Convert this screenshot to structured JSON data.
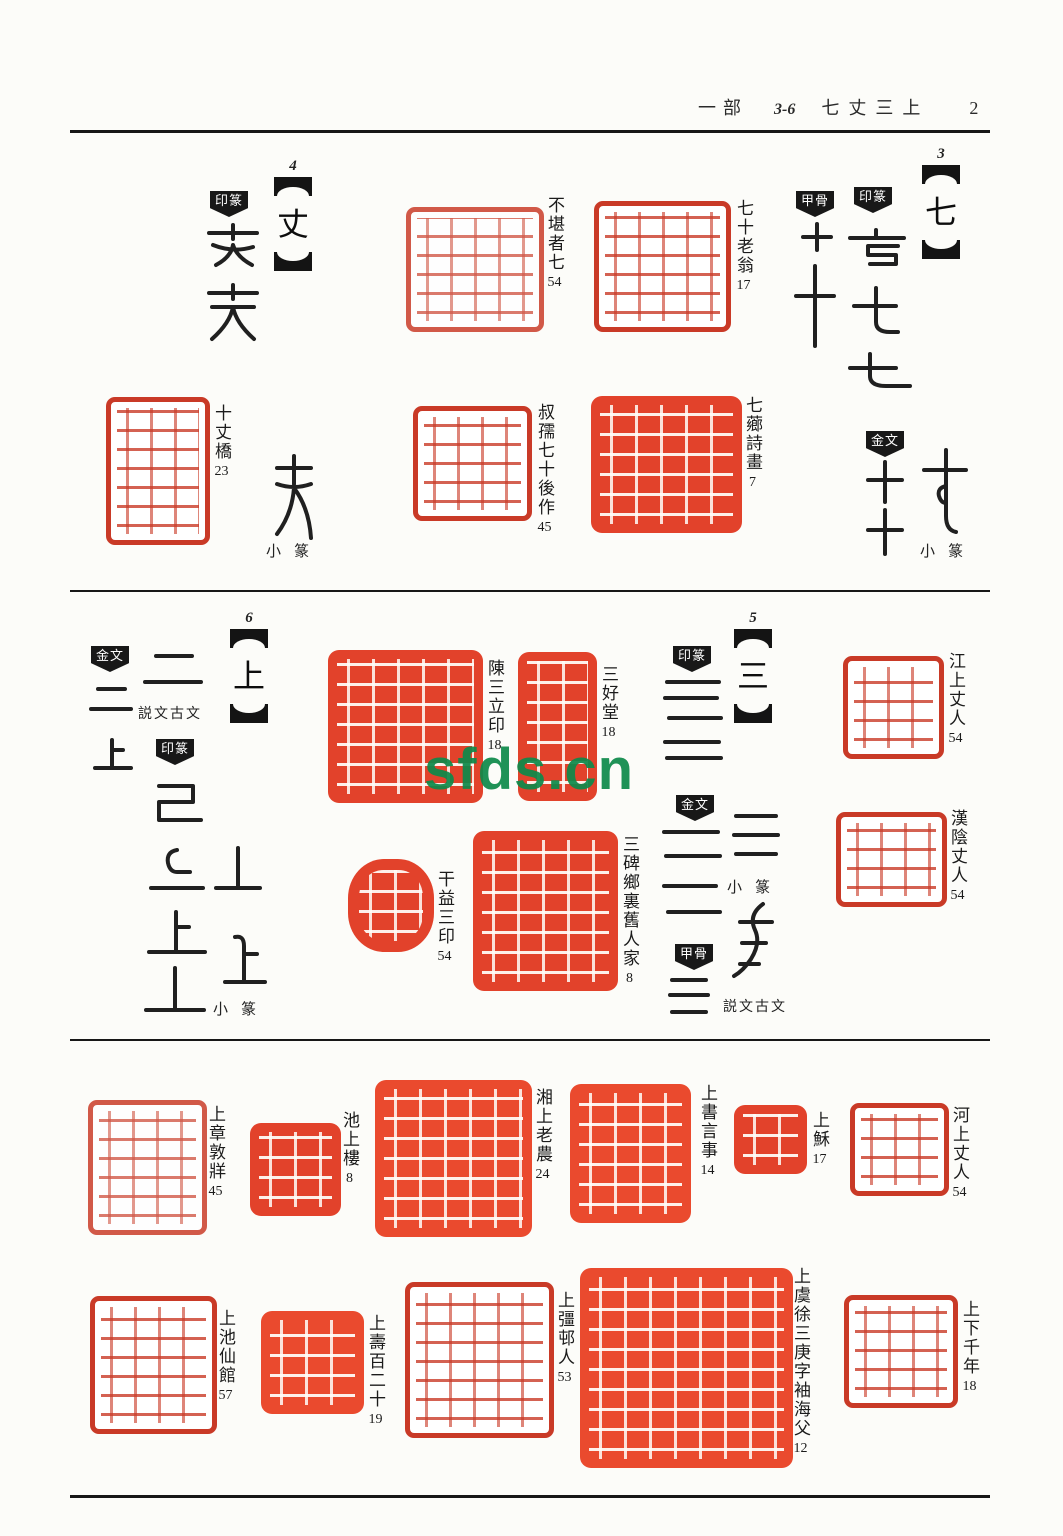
{
  "header": {
    "section": "一部",
    "locator": "3-6",
    "headwords": "七丈三上",
    "page": "2"
  },
  "watermark": {
    "text": "sfds.cn",
    "color": "#0f8a4b"
  },
  "colors": {
    "seal_red_outline": "#c93a27",
    "seal_red_solid": "#e2422b",
    "ink": "#1d1d1d",
    "watermark_green": "#0f8a4b"
  },
  "script_labels": {
    "yinzhuan": "印篆",
    "jiagu": "甲骨",
    "jinwen": "金文",
    "xiaozhuan": "小篆",
    "shuowen": "説文古文"
  },
  "entries": [
    {
      "no": "3",
      "headword": "七",
      "seals": [
        {
          "text": "不堪者七",
          "num": "54"
        },
        {
          "text": "七十老翁",
          "num": "17"
        },
        {
          "text": "叔孺七十後作",
          "num": "45"
        },
        {
          "text": "七薌詩畫",
          "num": "7"
        }
      ]
    },
    {
      "no": "4",
      "headword": "丈",
      "seals": [
        {
          "text": "十丈橋",
          "num": "23"
        }
      ]
    },
    {
      "no": "5",
      "headword": "三",
      "seals": [
        {
          "text": "江上丈人",
          "num": "54"
        },
        {
          "text": "漢陰丈人",
          "num": "54"
        },
        {
          "text": "陳三立印",
          "num": "18"
        },
        {
          "text": "三好堂",
          "num": "18"
        },
        {
          "text": "干益三印",
          "num": "54"
        },
        {
          "text": "三碑鄉裏舊人家",
          "num": "8"
        }
      ]
    },
    {
      "no": "6",
      "headword": "上",
      "seals": [
        {
          "text": "上章敦牂",
          "num": "45"
        },
        {
          "text": "池上樓",
          "num": "8"
        },
        {
          "text": "湘上老農",
          "num": "24"
        },
        {
          "text": "上書言事",
          "num": "14"
        },
        {
          "text": "上穌",
          "num": "17"
        },
        {
          "text": "河上丈人",
          "num": "54"
        },
        {
          "text": "上池仙館",
          "num": "57"
        },
        {
          "text": "上壽百二十",
          "num": "19"
        },
        {
          "text": "上彊邨人",
          "num": "53"
        },
        {
          "text": "上虞徐三庚字袖海父",
          "num": "12"
        },
        {
          "text": "上下千年",
          "num": "18"
        }
      ]
    }
  ]
}
